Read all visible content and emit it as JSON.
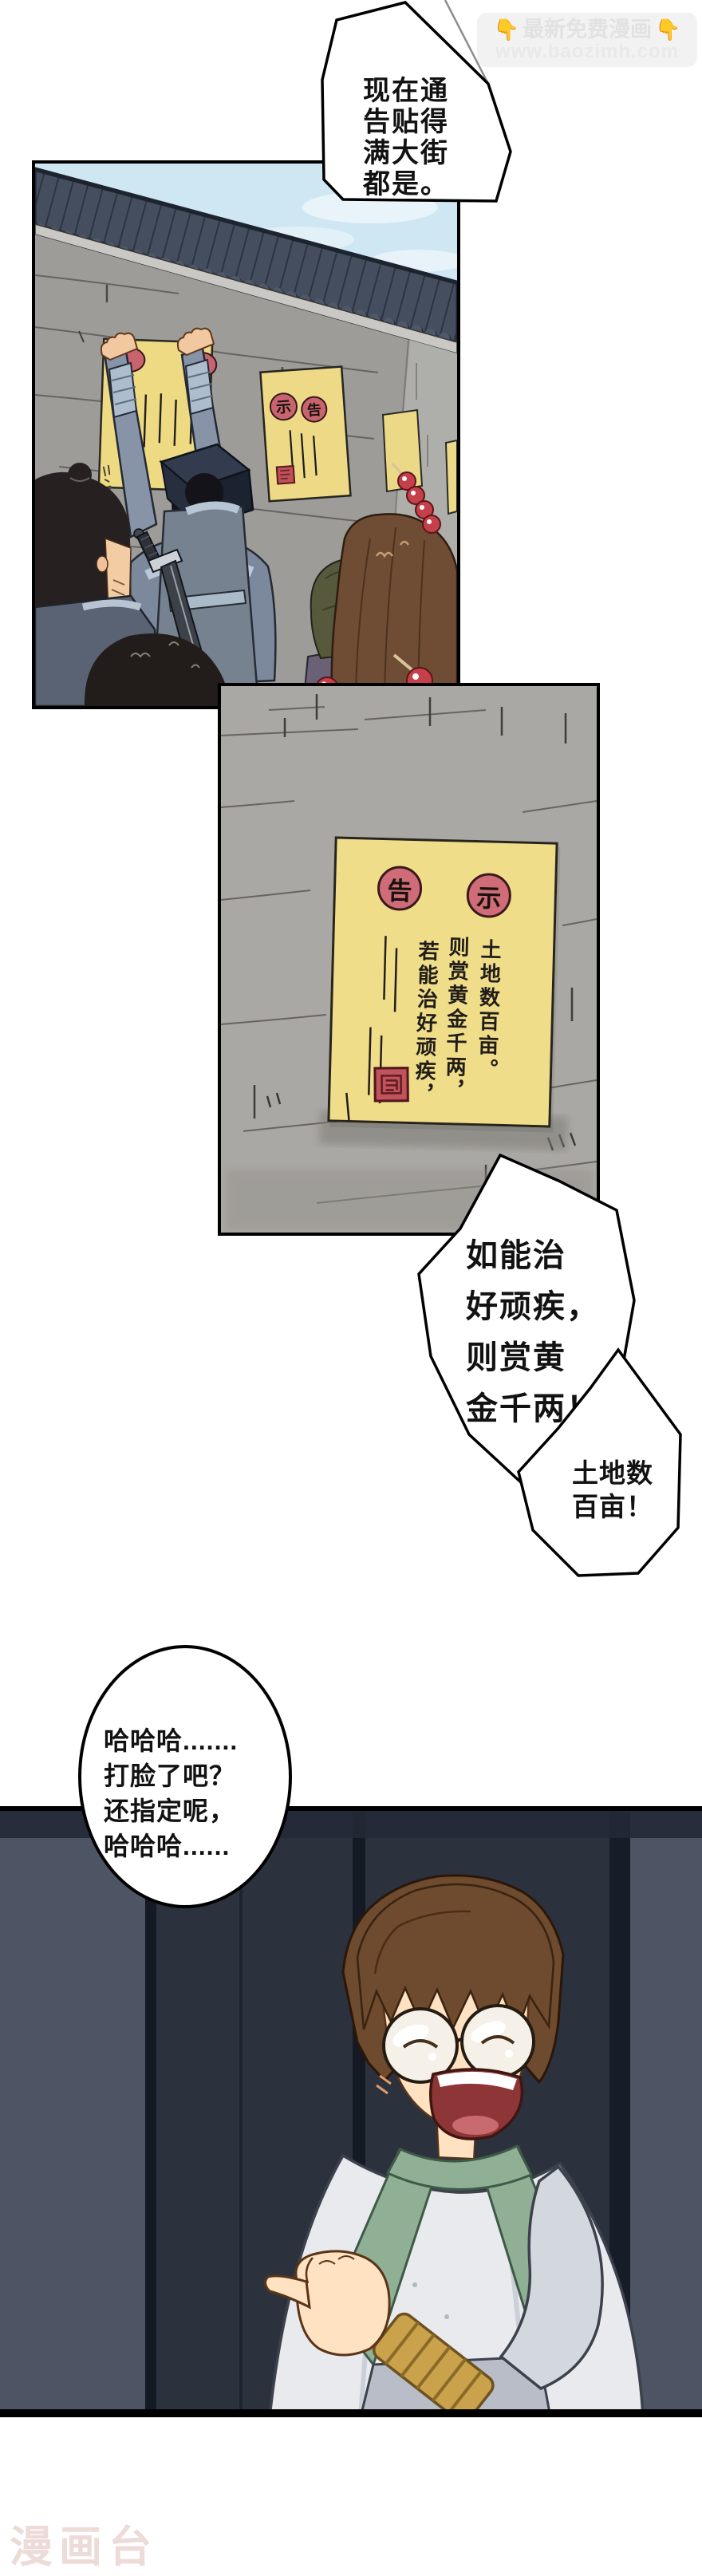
{
  "watermark_top": {
    "icon": "👇",
    "title": "最新免费漫画",
    "url": "www.baozimh.com"
  },
  "bubbles": {
    "b1": "现在通\n告贴得\n满大街\n都是。",
    "b2": "如能治\n好顽疾，\n则赏黄\n金千两！",
    "b3": "土地数\n百亩！",
    "b4": "哈哈哈.......\n打脸了吧？\n还指定呢，\n哈哈哈......"
  },
  "panel1": {
    "small_notice": {
      "seal_left": "示",
      "seal_right": "告"
    },
    "big_notice": {
      "seal": "告"
    }
  },
  "panel2": {
    "notice": {
      "seal_left": "告",
      "seal_right": "示",
      "col_left": "若能治好顽疾，",
      "col_mid": "则赏黄金千两，",
      "col_right": "土地数百亩。"
    }
  },
  "watermark_bottom": {
    "text": "漫画台"
  },
  "colors": {
    "notice_yellow": "#f0dd8a",
    "seal_red": "#d06c77",
    "sky": "#cfe7f3",
    "panel3_bg": "#2b323e",
    "bubble_border": "#000000"
  }
}
